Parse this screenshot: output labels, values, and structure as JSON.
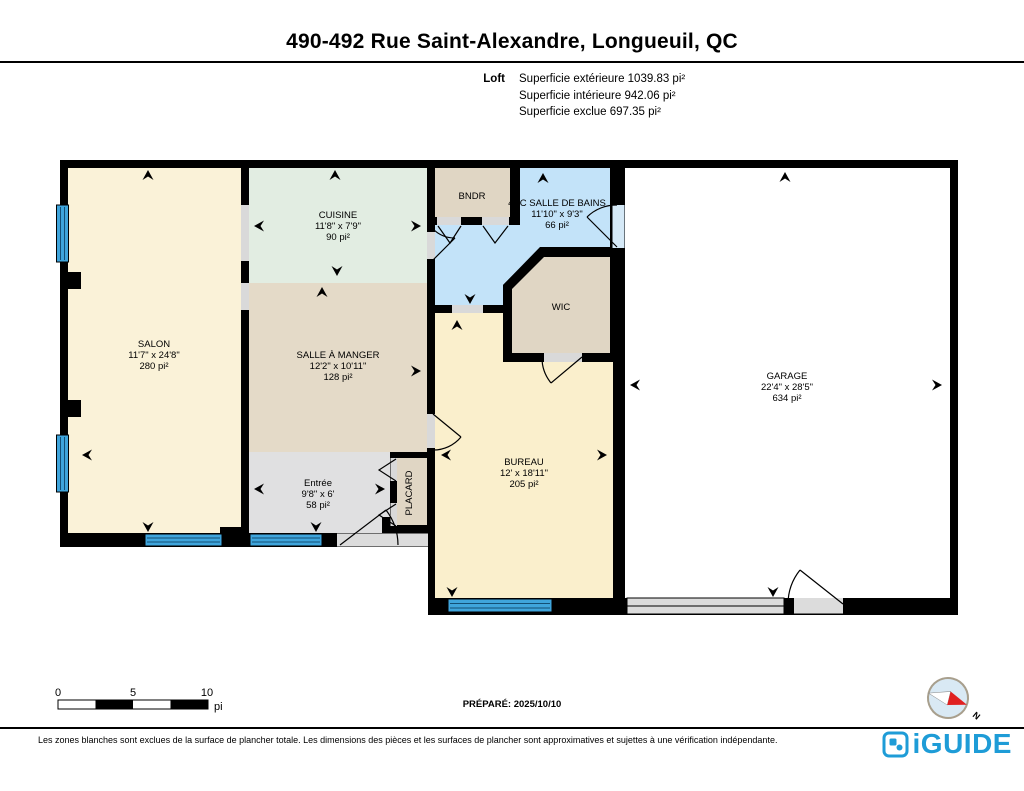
{
  "header": {
    "title": "490-492 Rue Saint-Alexandre, Longueuil, QC",
    "floor_label": "Loft",
    "area_lines": [
      "Superficie extérieure 1039.83 pi²",
      "Superficie intérieure 942.06 pi²",
      "Superficie exclue 697.35 pi²"
    ]
  },
  "rooms": {
    "salon": {
      "name": "SALON",
      "dims": "11'7\" x 24'8\"",
      "area": "280 pi²"
    },
    "cuisine": {
      "name": "CUISINE",
      "dims": "11'8\" x 7'9\"",
      "area": "90 pi²"
    },
    "salle_a_manger": {
      "name": "SALLE À MANGER",
      "dims": "12'2\" x 10'11\"",
      "area": "128 pi²"
    },
    "bndr": {
      "name": "BNDR"
    },
    "salle_de_bains": {
      "name": "4PC SALLE DE BAINS",
      "dims": "11'10\" x 9'3\"",
      "area": "66 pi²"
    },
    "wic": {
      "name": "WIC"
    },
    "entree": {
      "name": "Entrée",
      "dims": "9'8\" x 6'",
      "area": "58 pi²"
    },
    "placard": {
      "name": "PLACARD"
    },
    "bureau": {
      "name": "BUREAU",
      "dims": "12' x 18'11\"",
      "area": "205 pi²"
    },
    "garage": {
      "name": "GARAGE",
      "dims": "22'4\" x 28'5\"",
      "area": "634 pi²"
    }
  },
  "scale_bar": {
    "ticks": [
      "0",
      "5",
      "10"
    ],
    "unit": "pi"
  },
  "prepared_label": "PRÉPARÉ: 2025/10/10",
  "compass": {
    "north_label": "N"
  },
  "footer": {
    "disclaimer": "Les zones blanches sont exclues de la surface de plancher totale. Les dimensions des pièces et les surfaces de plancher sont approximatives et sujettes à une vérification indépendante.",
    "brand": "iGUIDE"
  },
  "colors": {
    "wall": "#000000",
    "window_blue": "#3FA5DC",
    "bathroom_blue": "#C3E3F9",
    "salon_cream": "#FAF2D8",
    "bureau_cream": "#FAEFCC",
    "cuisine_mint": "#E2EDE2",
    "dining_tan": "#E4DAC8",
    "closet_beige": "#E0D6C4",
    "entry_grey": "#E0E0E1",
    "door_grey": "#DCDCDC",
    "brand_blue": "#1E9CD7",
    "compass_red": "#E02020"
  }
}
